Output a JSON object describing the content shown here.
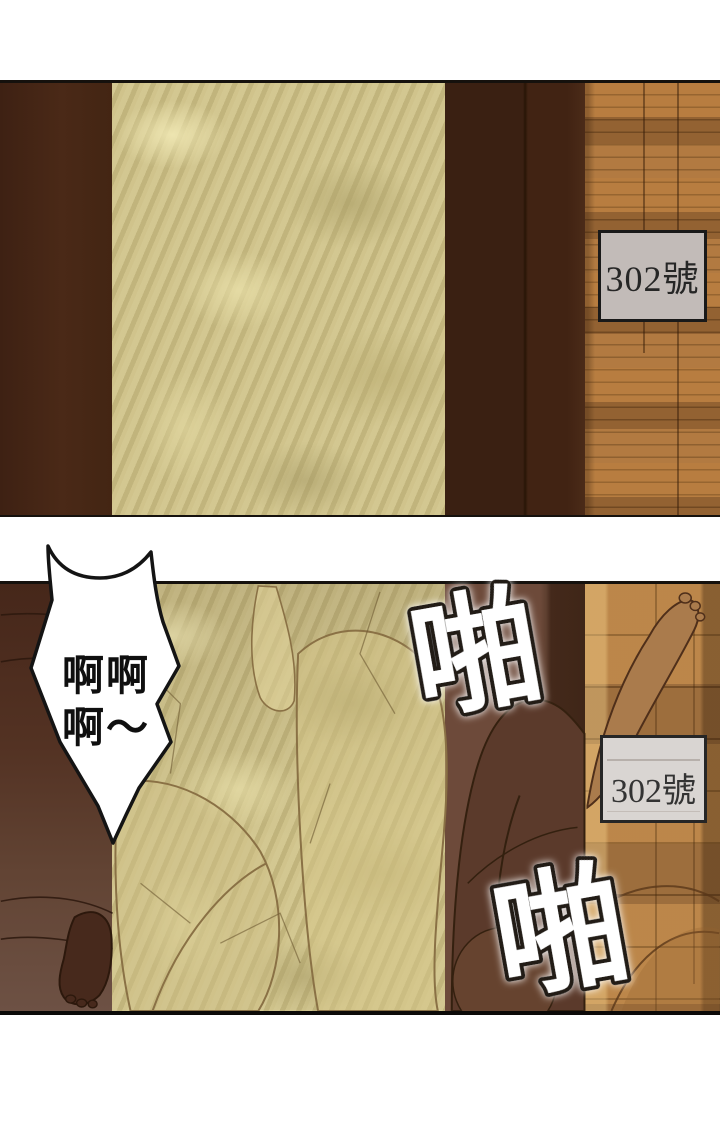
{
  "panel1": {
    "door_sign": {
      "label": "302號"
    }
  },
  "panel2": {
    "door_sign": {
      "label": "302號"
    },
    "speech_bubble": {
      "line1": "啊啊",
      "line2": "啊～"
    },
    "sfx_top": "啪",
    "sfx_bottom": "啪"
  },
  "colors": {
    "door_dark_brown": "#402314",
    "door_right_brown": "#6b4838",
    "frosted_glass_gold": "#ccbf86",
    "wood_wall": "#a9713a",
    "wood_floor": "#b07c44",
    "sign_gray": "#c2bbb8",
    "sign_light": "#d9d5d2",
    "sfx_fill": "#ffffff",
    "line_black": "#15110d"
  }
}
